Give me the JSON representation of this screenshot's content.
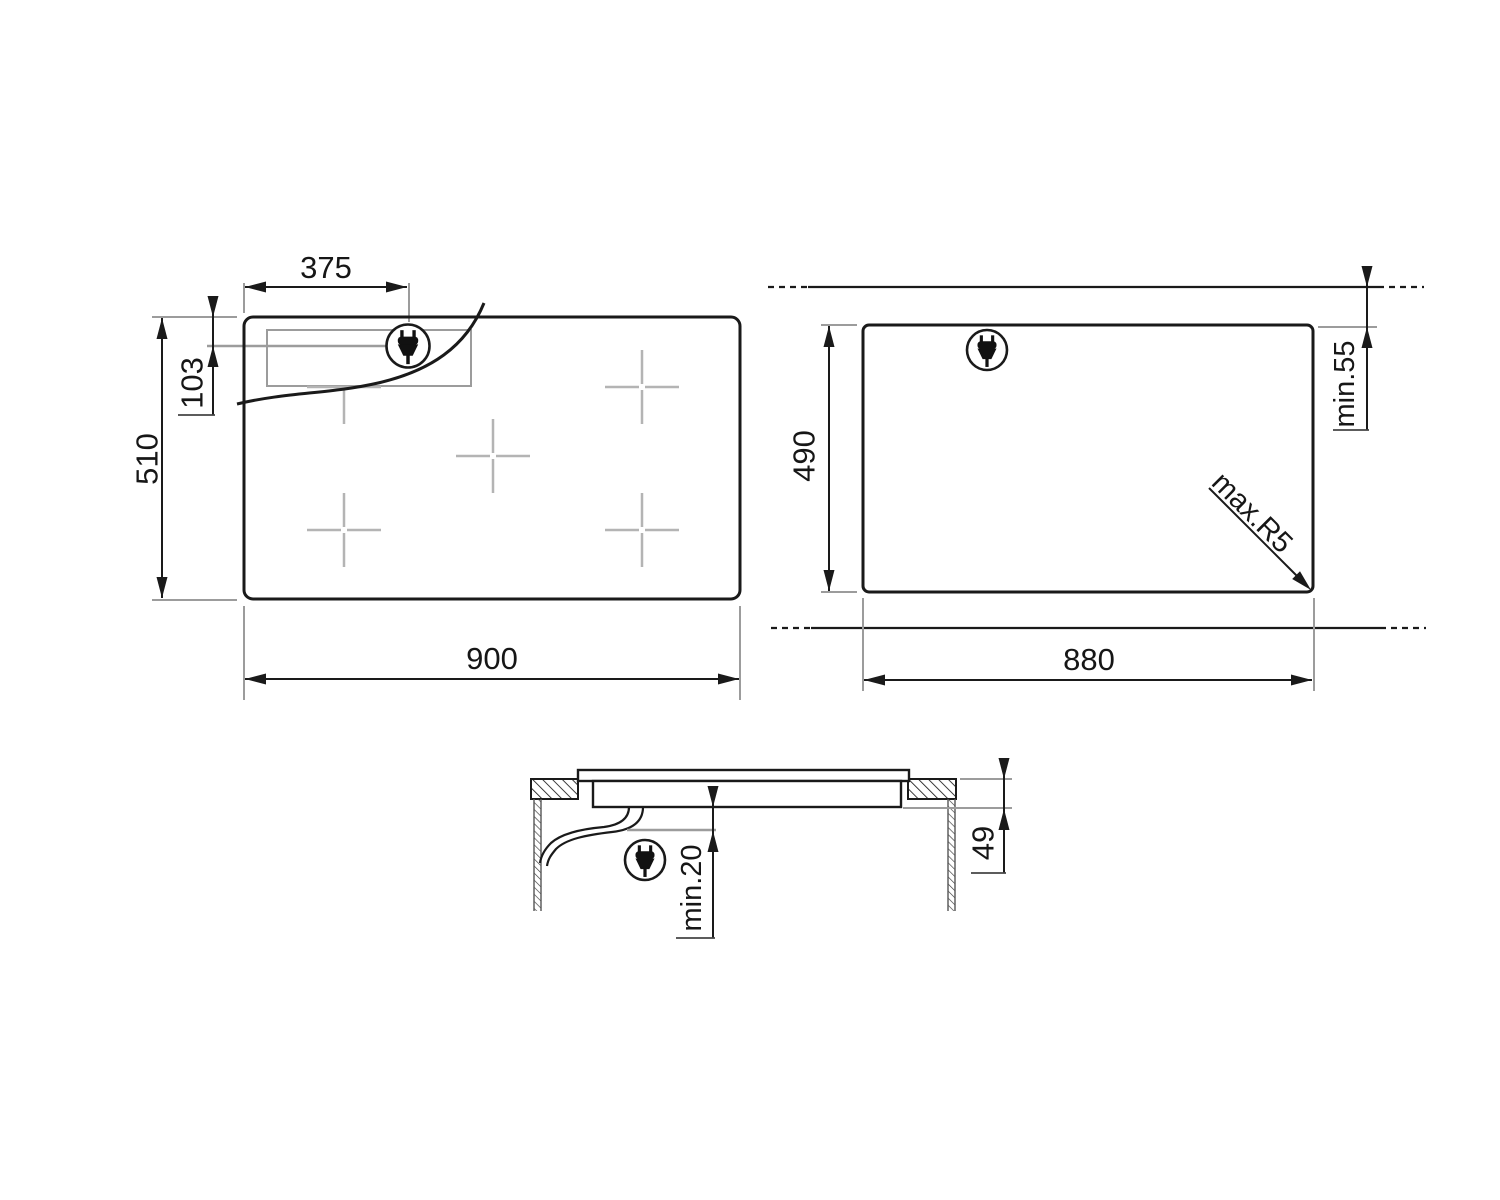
{
  "drawing": {
    "title": "hob-installation-diagram",
    "colors": {
      "background": "#ffffff",
      "line": "#1a1a1a",
      "guide": "#9c9c9c",
      "cross": "#b4b4b4"
    },
    "top_view": {
      "width": "900",
      "depth": "510",
      "plug_offset_x": "375",
      "plug_offset_y": "103",
      "plug_icon": "power-plug"
    },
    "cutout_view": {
      "width": "880",
      "depth": "490",
      "rear_clearance": "min.55",
      "corner_radius": "max.R5",
      "plug_icon": "power-plug"
    },
    "side_view": {
      "installed_depth": "49",
      "clearance_below": "min.20",
      "plug_icon": "power-plug"
    }
  }
}
